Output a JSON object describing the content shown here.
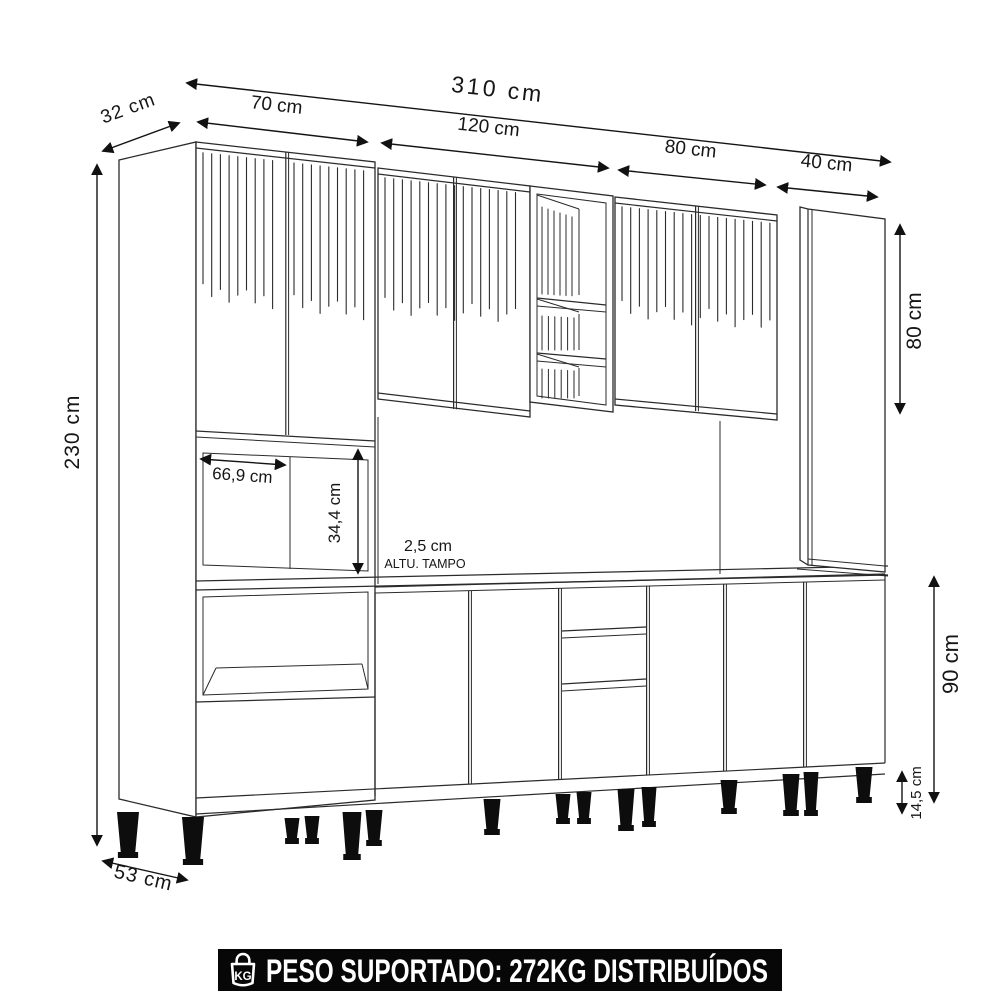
{
  "annotations": {
    "total_width": "310 cm",
    "top_depth": "32 cm",
    "left_section_width": "70 cm",
    "middle_section_width": "120 cm",
    "right_section_width": "80 cm",
    "far_right_section_width": "40 cm",
    "total_height": "230 cm",
    "upper_right_cabinet_height": "80 cm",
    "niche_width": "66,9 cm",
    "niche_height": "34,4 cm",
    "countertop_thickness": "2,5 cm",
    "countertop_caption": "ALTU. TAMPO",
    "base_cabinet_height": "90 cm",
    "feet_height": "14,5 cm",
    "bottom_depth": "53 cm"
  },
  "footer": {
    "badge": "KG",
    "label": "PESO SUPORTADO: 272KG DISTRIBUÍDOS"
  },
  "colors": {
    "line": "#2b2b2b",
    "banner_bg": "#070707",
    "banner_text": "#ffffff"
  }
}
